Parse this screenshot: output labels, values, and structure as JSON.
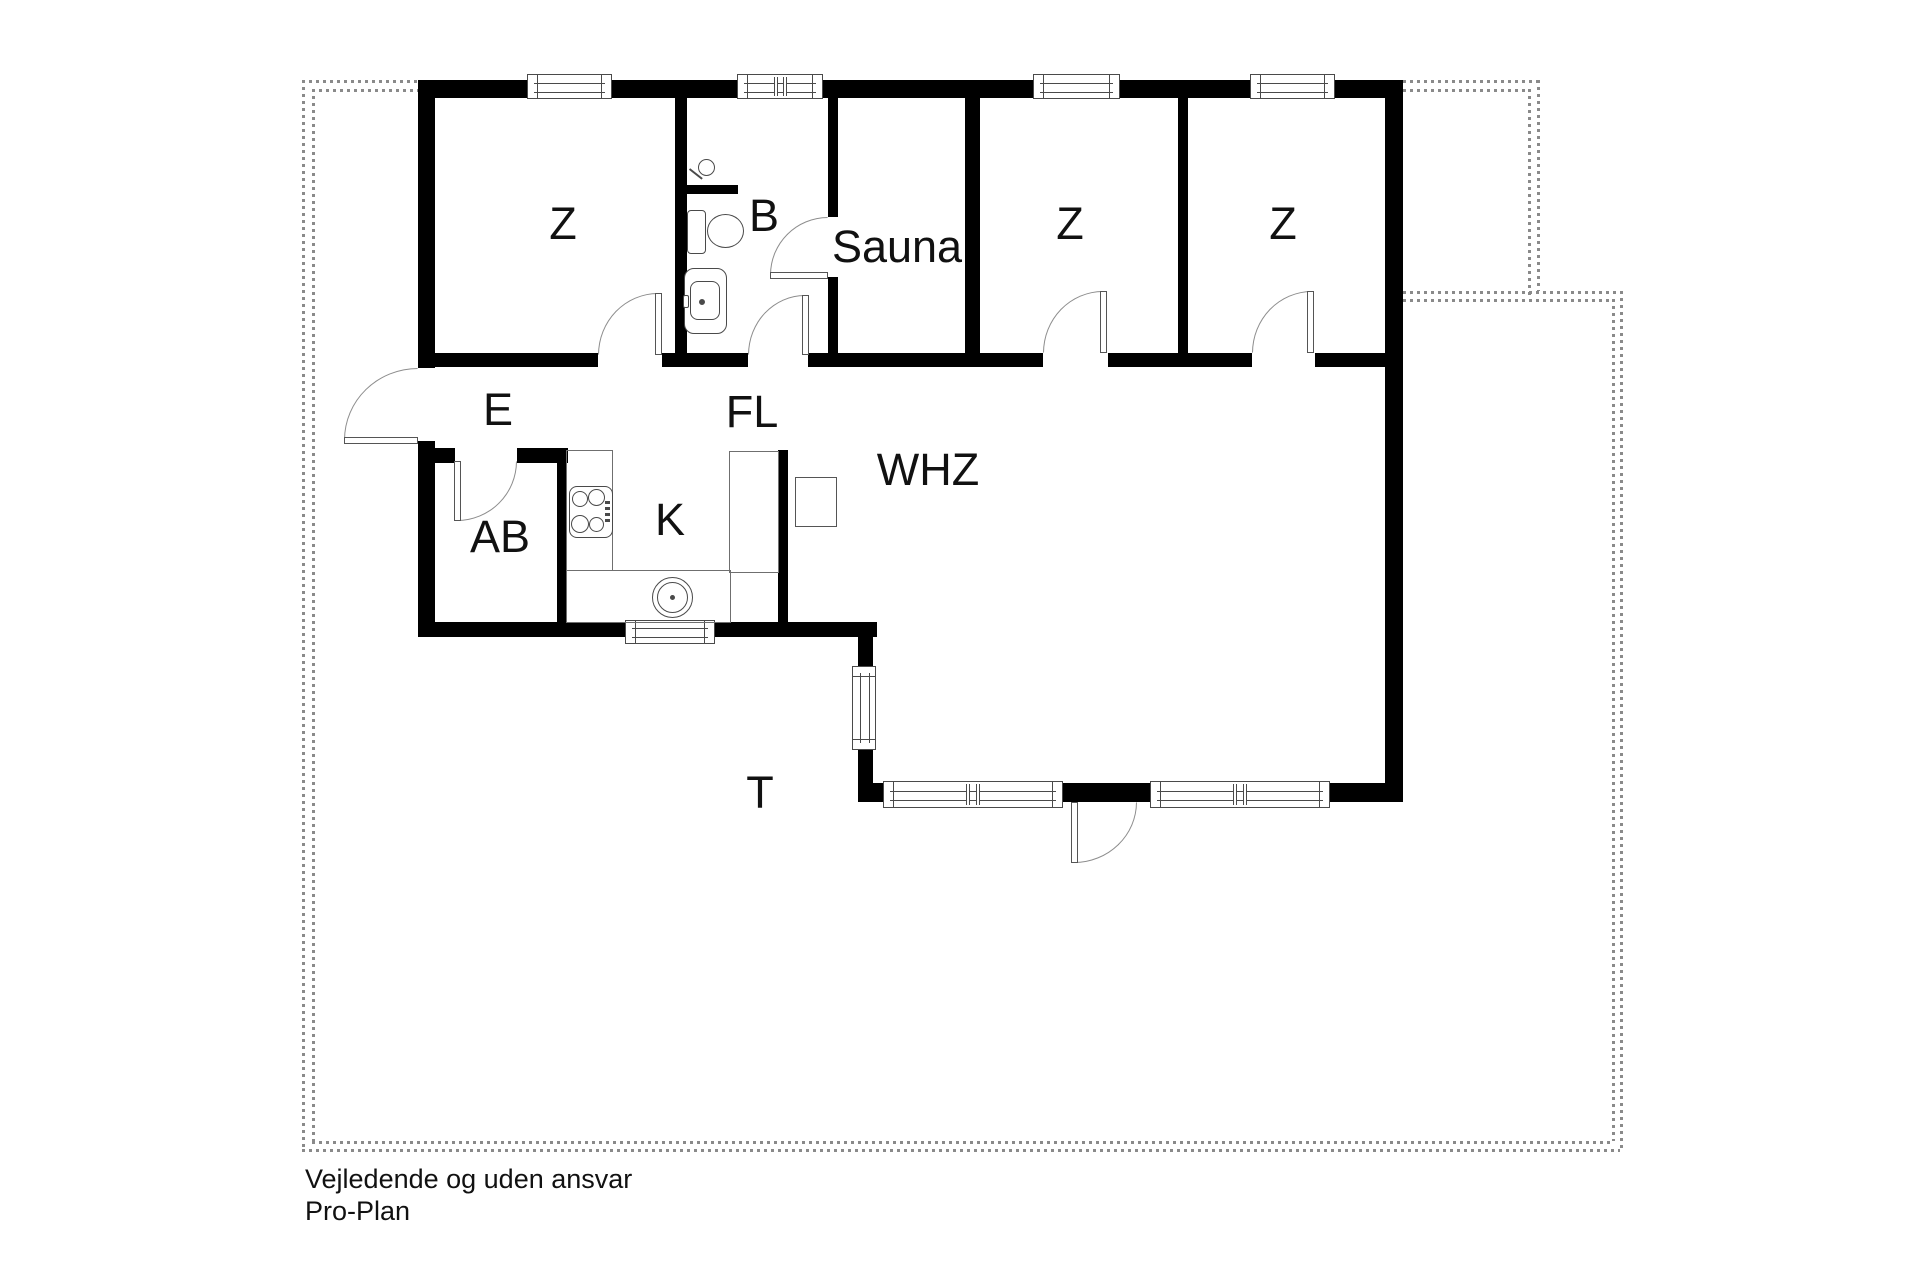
{
  "plan": {
    "type": "floor-plan",
    "rooms": [
      {
        "id": "bedroom-1",
        "label": "Z"
      },
      {
        "id": "bathroom",
        "label": "B"
      },
      {
        "id": "sauna",
        "label": "Sauna"
      },
      {
        "id": "bedroom-2",
        "label": "Z"
      },
      {
        "id": "bedroom-3",
        "label": "Z"
      },
      {
        "id": "entrance",
        "label": "E"
      },
      {
        "id": "hallway",
        "label": "FL"
      },
      {
        "id": "utility",
        "label": "AB"
      },
      {
        "id": "kitchen",
        "label": "K"
      },
      {
        "id": "living-room",
        "label": "WHZ"
      },
      {
        "id": "terrace",
        "label": "T"
      }
    ],
    "footer": {
      "line1": "Vejledende og uden ansvar",
      "line2": "Pro-Plan"
    },
    "colors": {
      "wall": "#000000",
      "thin_line": "#6f6f6f",
      "door_arc": "#8d8d8d",
      "dashed_boundary": "#8a8a8a",
      "background": "#ffffff",
      "text": "#111111"
    }
  }
}
